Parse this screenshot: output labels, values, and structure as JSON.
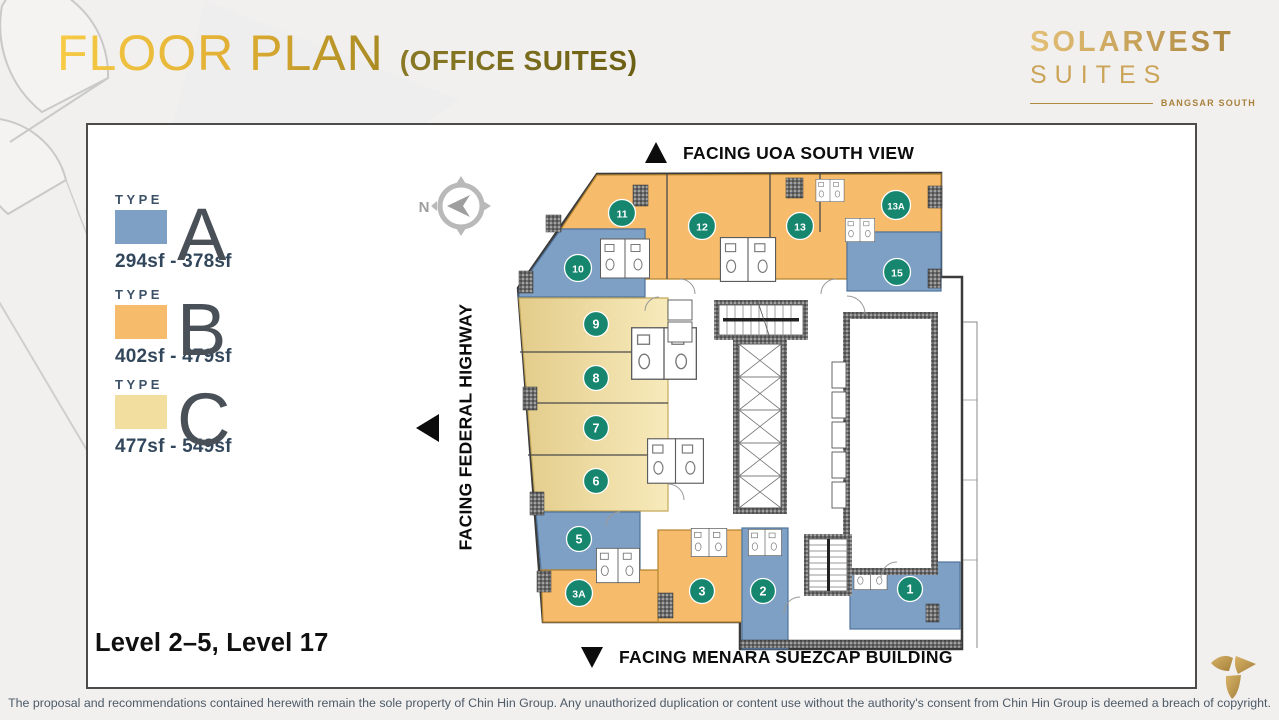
{
  "header": {
    "title": "FLOOR PLAN",
    "subtitle": "(OFFICE SUITES)"
  },
  "brand": {
    "name": "SOLARVEST",
    "product": "SUITES",
    "location": "BANGSAR SOUTH"
  },
  "legend": {
    "type_label": "TYPE",
    "items": [
      {
        "letter": "A",
        "range": "294sf - 378sf",
        "color": "#7EA0C5"
      },
      {
        "letter": "B",
        "range": "402sf - 479sf",
        "color": "#F6BC6C"
      },
      {
        "letter": "C",
        "range": "477sf - 549sf",
        "color": "#F2DF9F"
      }
    ]
  },
  "compass": {
    "label": "N"
  },
  "plan": {
    "facing_top": "FACING UOA SOUTH VIEW",
    "facing_left": "FACING FEDERAL HIGHWAY",
    "facing_bottom": "FACING MENARA SUEZCAP BUILDING",
    "units": [
      {
        "label": "1",
        "type": "A",
        "x": 910,
        "y": 589
      },
      {
        "label": "2",
        "type": "A",
        "x": 763,
        "y": 591
      },
      {
        "label": "3",
        "type": "B",
        "x": 702,
        "y": 591
      },
      {
        "label": "3A",
        "type": "B",
        "x": 579,
        "y": 593
      },
      {
        "label": "5",
        "type": "A",
        "x": 579,
        "y": 539
      },
      {
        "label": "6",
        "type": "C",
        "x": 596,
        "y": 481
      },
      {
        "label": "7",
        "type": "C",
        "x": 596,
        "y": 428
      },
      {
        "label": "8",
        "type": "C",
        "x": 596,
        "y": 378
      },
      {
        "label": "9",
        "type": "C",
        "x": 596,
        "y": 324
      },
      {
        "label": "10",
        "type": "A",
        "x": 578,
        "y": 268
      },
      {
        "label": "11",
        "type": "B",
        "x": 622,
        "y": 213
      },
      {
        "label": "12",
        "type": "B",
        "x": 702,
        "y": 226
      },
      {
        "label": "13",
        "type": "B",
        "x": 800,
        "y": 226
      },
      {
        "label": "13A",
        "type": "B",
        "x": 896,
        "y": 205
      },
      {
        "label": "15",
        "type": "A",
        "x": 897,
        "y": 272
      }
    ]
  },
  "level_label": "Level 2–5, Level 17",
  "footer": {
    "disclaimer": "The proposal and recommendations contained herewith remain the sole property of Chin Hin Group. Any unauthorized duplication or content use without the authority's consent from Chin Hin Group is deemed a breach of copyright."
  },
  "colors": {
    "accent_gold": "#D9A62E",
    "badge_teal": "#17866F",
    "type_a_blue": "#7EA0C5",
    "type_b_orange": "#F6BC6C",
    "type_c_yellow": "#F2DF9F",
    "wall": "#3B3B3B"
  }
}
